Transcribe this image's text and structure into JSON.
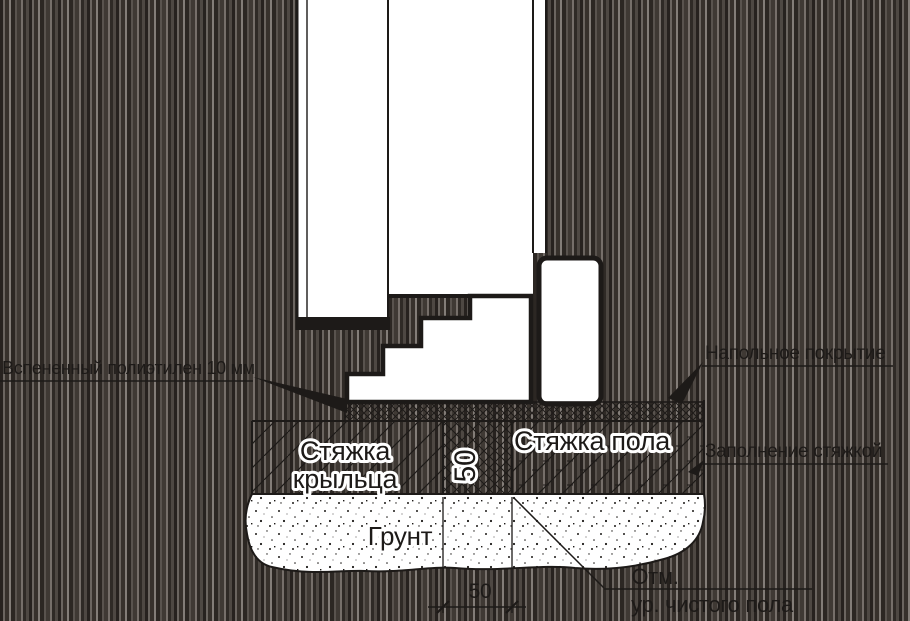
{
  "drawing": {
    "labels": {
      "foam_pad": "Вспененный полиэтилен 10 мм",
      "floor_covering": "Напольное покрытие",
      "screed_filling": "Заполнение стяжкой",
      "porch_screed_line1": "Стяжка",
      "porch_screed_line2": "крыльца",
      "floor_screed": "Стяжка пола",
      "ground": "Грунт",
      "elevation_line1": "Отм.",
      "elevation_line2": "ур. чистого пола"
    },
    "dimensions": {
      "gap_width": "50",
      "bottom_width": "50"
    },
    "colors": {
      "line": "#1d1a18",
      "paper": "#ffffff",
      "background_dark": "#2a2522"
    }
  }
}
